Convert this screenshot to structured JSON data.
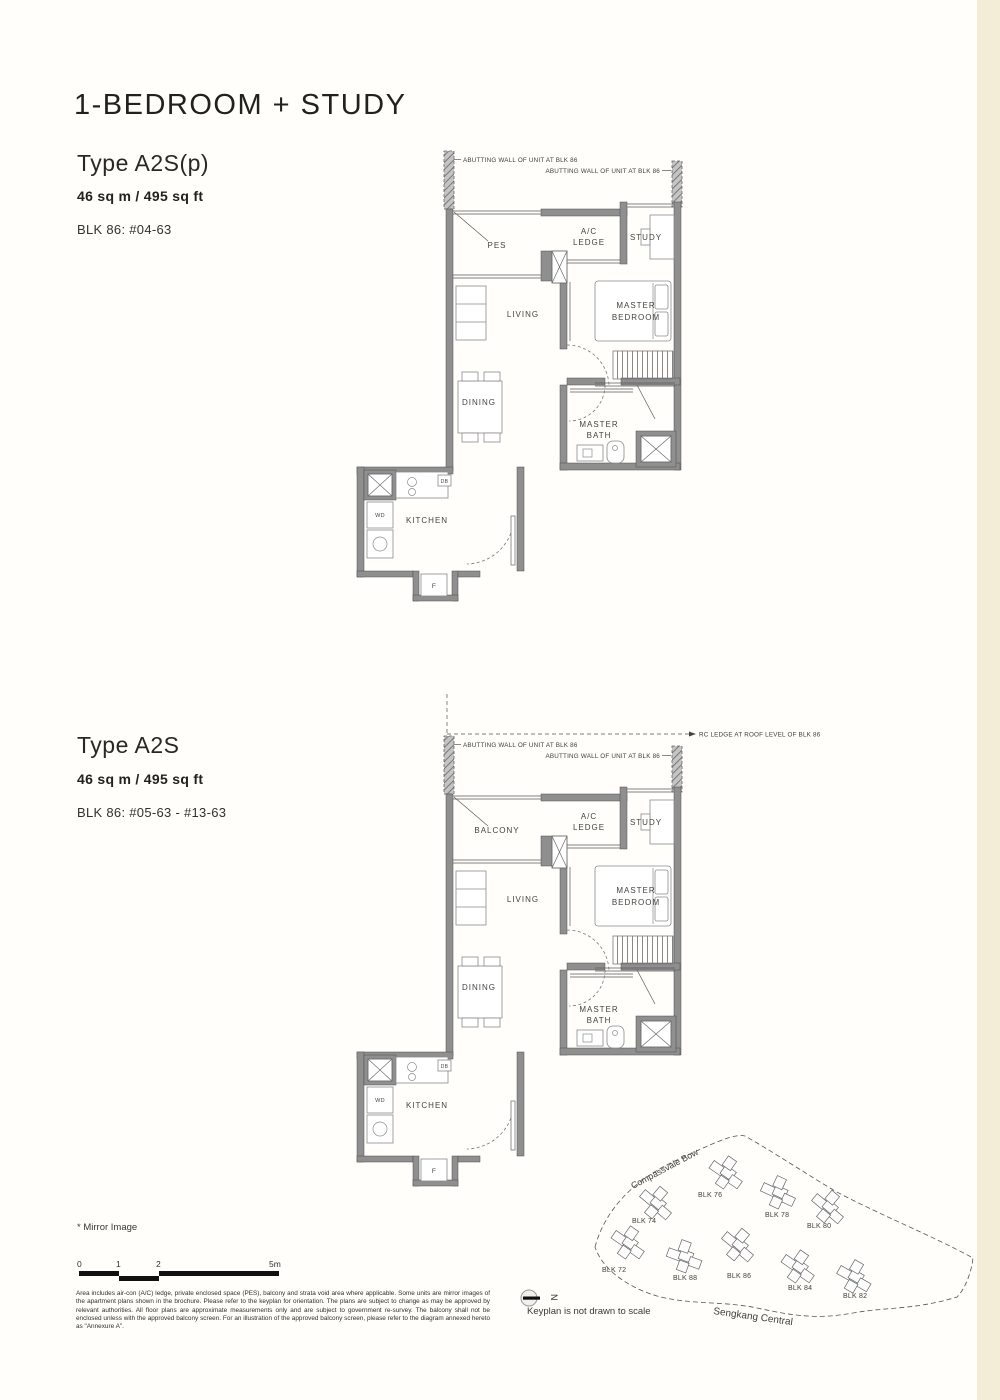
{
  "page": {
    "title": "1-BEDROOM + STUDY"
  },
  "plan_a2sp": {
    "type": "Type A2S(p)",
    "area": "46 sq m / 495 sq ft",
    "units": "BLK 86: #04-63",
    "annotations": {
      "abutting_left": "ABUTTING WALL OF UNIT AT BLK 86",
      "abutting_right": "ABUTTING WALL OF UNIT AT BLK 86"
    },
    "rooms": {
      "outdoor": "PES",
      "ac1": "A/C",
      "ac2": "LEDGE",
      "study": "STUDY",
      "mb1": "MASTER",
      "mb2": "BEDROOM",
      "living": "LIVING",
      "dining": "DINING",
      "bath1": "MASTER",
      "bath2": "BATH",
      "kitchen": "KITCHEN",
      "wd": "WD",
      "db": "DB",
      "fridge": "F"
    }
  },
  "plan_a2s": {
    "type": "Type A2S",
    "area": "46 sq m / 495 sq ft",
    "units": "BLK 86: #05-63 - #13-63",
    "annotations": {
      "abutting_left": "ABUTTING WALL OF UNIT AT BLK 86",
      "abutting_right": "ABUTTING WALL OF UNIT AT BLK 86",
      "rc_ledge": "RC LEDGE AT ROOF LEVEL OF BLK 86"
    },
    "rooms": {
      "outdoor": "BALCONY",
      "ac1": "A/C",
      "ac2": "LEDGE",
      "study": "STUDY",
      "mb1": "MASTER",
      "mb2": "BEDROOM",
      "living": "LIVING",
      "dining": "DINING",
      "bath1": "MASTER",
      "bath2": "BATH",
      "kitchen": "KITCHEN",
      "wd": "WD",
      "db": "DB",
      "fridge": "F"
    }
  },
  "keyplan": {
    "road_top": "Compassvale Bow",
    "road_bottom": "Sengkang Central",
    "note": "Keyplan is not drawn to scale",
    "north": "N",
    "blocks": [
      {
        "label": "BLK 74"
      },
      {
        "label": "BLK 76"
      },
      {
        "label": "BLK 78"
      },
      {
        "label": "BLK 80"
      },
      {
        "label": "BLK 72"
      },
      {
        "label": "BLK 88"
      },
      {
        "label": "BLK 86"
      },
      {
        "label": "BLK 84"
      },
      {
        "label": "BLK 82"
      }
    ]
  },
  "footer": {
    "mirror": "* Mirror Image",
    "scale_ticks": {
      "t0": "0",
      "t1": "1",
      "t2": "2",
      "t3": "5m"
    },
    "disclaimer": "Area includes air-con (A/C) ledge, private enclosed space (PES), balcony and strata void area where applicable. Some units are mirror images of the apartment plans shown in the brochure. Please refer to the keyplan for orientation. The plans are subject to change as may be approved by relevant authorities. All floor plans are approximate measurements only and are subject to government re-survey. The balcony shall not be enclosed unless with the approved balcony screen. For an illustration of the approved balcony screen, please refer to the diagram annexed hereto as \"Annexure A\"."
  }
}
